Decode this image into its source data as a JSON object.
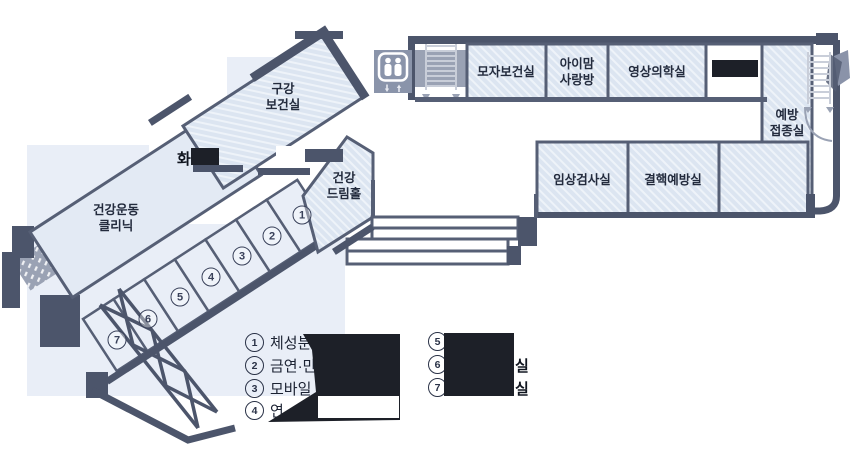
{
  "floorplan": {
    "rooms": {
      "mother_child": "모자보건실",
      "imam_line1": "아이맘",
      "imam_line2": "사랑방",
      "imaging": "영상의학실",
      "vaccination_line1": "예방",
      "vaccination_line2": "접종실",
      "clinical_lab": "임상검사실",
      "tb_prevention": "결핵예방실",
      "oral_line1": "구강",
      "oral_line2": "보건실",
      "dream_line1": "건강",
      "dream_line2": "드림홀",
      "exercise_line1": "건강운동",
      "exercise_line2": "클리닉",
      "restroom_partial": "화"
    },
    "numbers": [
      "1",
      "2",
      "3",
      "4",
      "5",
      "6",
      "7"
    ],
    "legend": {
      "items_left": [
        {
          "num": "1",
          "text": "체성분"
        },
        {
          "num": "2",
          "text": "금연·만성"
        },
        {
          "num": "3",
          "text": "모바일"
        },
        {
          "num": "4",
          "text": "연"
        }
      ],
      "items_right": [
        {
          "num": "5",
          "suffix": ""
        },
        {
          "num": "6",
          "suffix": "실"
        },
        {
          "num": "7",
          "suffix": "실"
        }
      ]
    },
    "icons": {
      "elevator": "elevator",
      "stairs_top": "stairs",
      "stairs_right": "stairs",
      "exterior_ramp": "exterior-stairs",
      "exterior_truss": "exterior-stairs"
    },
    "colors": {
      "hatch_fill": "#dce5f1",
      "plain_fill": "#e3eaf4",
      "wall_dark": "#4c556b",
      "wall_line": "#565f75",
      "backdrop": "#e9eef7",
      "icon_gray": "#9aa2b4",
      "redaction_black": "#1d2028",
      "text": "#232b3d"
    }
  }
}
